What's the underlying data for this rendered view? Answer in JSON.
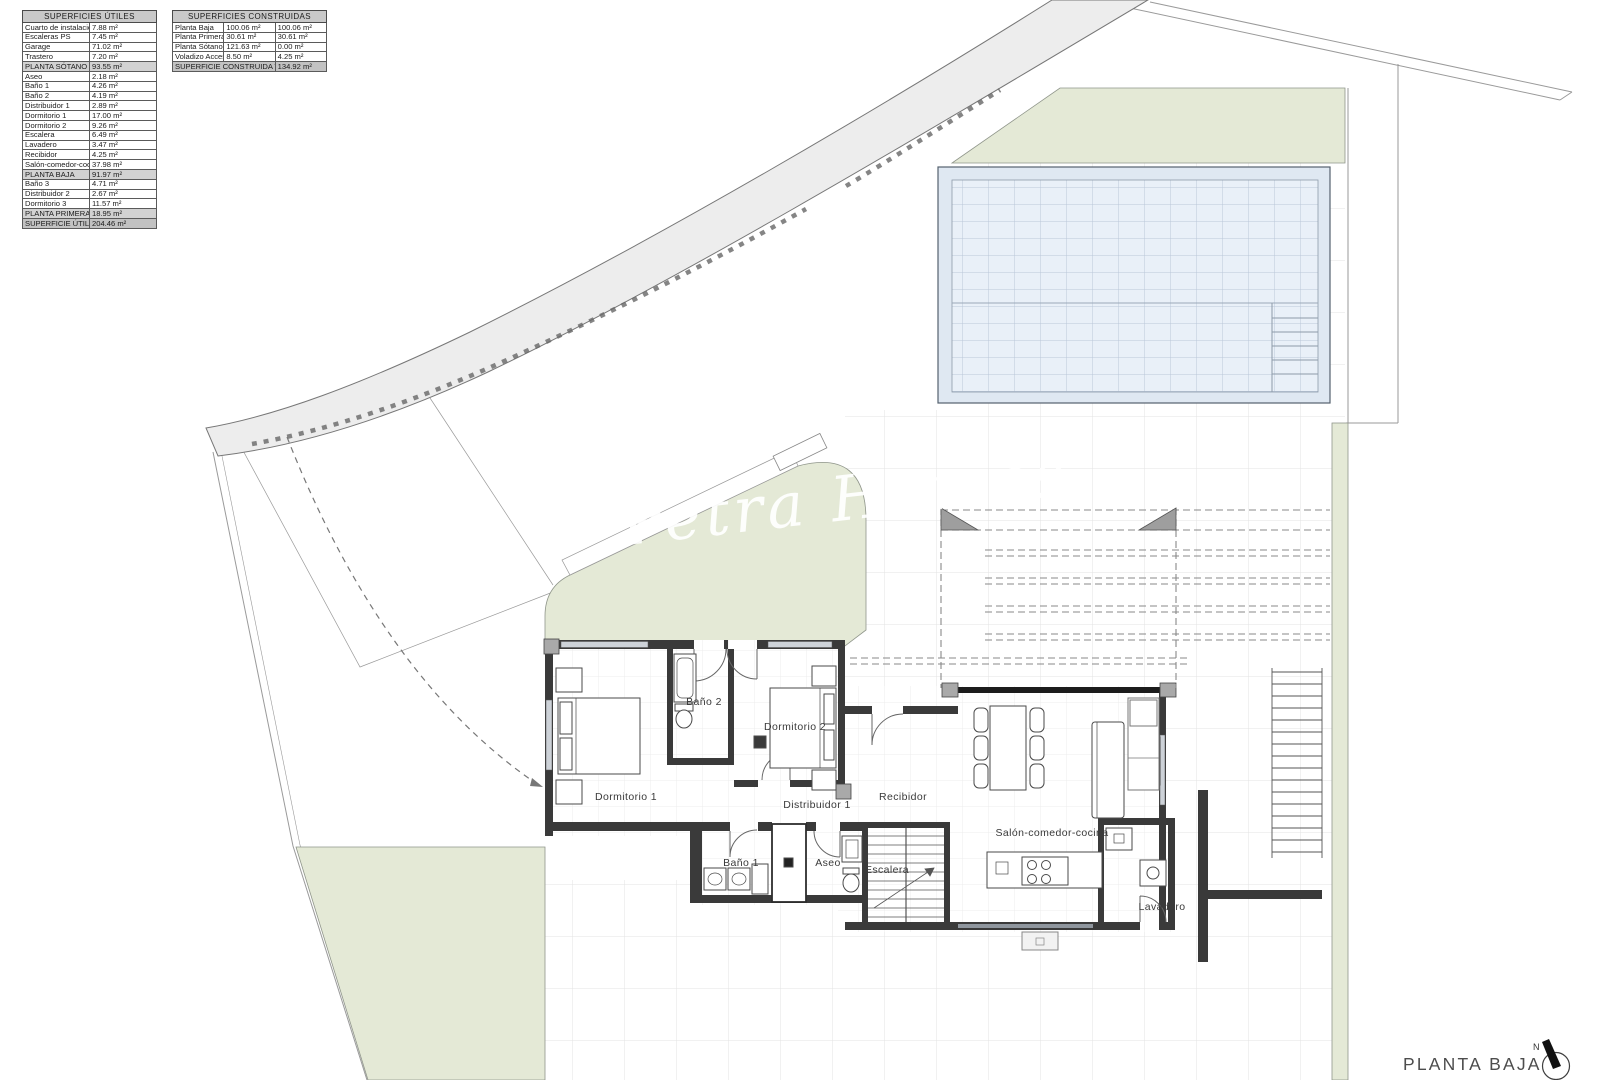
{
  "plan_title": "PLANTA BAJA",
  "watermark": "Petra Homes",
  "north_label": "N",
  "surface_tables": [
    {
      "id": "utiles",
      "title": "SUPERFICIES ÚTILES",
      "cols": 2,
      "rows": [
        {
          "label": "Cuarto de instalaciones",
          "values": [
            "7.88 m²"
          ]
        },
        {
          "label": "Escaleras PS",
          "values": [
            "7.45 m²"
          ]
        },
        {
          "label": "Garage",
          "values": [
            "71.02 m²"
          ]
        },
        {
          "label": "Trastero",
          "values": [
            "7.20 m²"
          ]
        },
        {
          "label": "PLANTA SÓTANO",
          "values": [
            "93.55 m²"
          ],
          "style": "subtotal"
        },
        {
          "label": "Aseo",
          "values": [
            "2.18 m²"
          ]
        },
        {
          "label": "Baño 1",
          "values": [
            "4.26 m²"
          ]
        },
        {
          "label": "Baño 2",
          "values": [
            "4.19 m²"
          ]
        },
        {
          "label": "Distribuidor 1",
          "values": [
            "2.89 m²"
          ]
        },
        {
          "label": "Dormitorio 1",
          "values": [
            "17.00 m²"
          ]
        },
        {
          "label": "Dormitorio 2",
          "values": [
            "9.26 m²"
          ]
        },
        {
          "label": "Escalera",
          "values": [
            "6.49 m²"
          ]
        },
        {
          "label": "Lavadero",
          "values": [
            "3.47 m²"
          ]
        },
        {
          "label": "Recibidor",
          "values": [
            "4.25 m²"
          ]
        },
        {
          "label": "Salón-comedor-cocina",
          "values": [
            "37.98 m²"
          ]
        },
        {
          "label": "PLANTA BAJA",
          "values": [
            "91.97 m²"
          ],
          "style": "subtotal"
        },
        {
          "label": "Baño 3",
          "values": [
            "4.71 m²"
          ]
        },
        {
          "label": "Distribuidor 2",
          "values": [
            "2.67 m²"
          ]
        },
        {
          "label": "Dormitorio 3",
          "values": [
            "11.57 m²"
          ]
        },
        {
          "label": "PLANTA PRIMERA",
          "values": [
            "18.95 m²"
          ],
          "style": "subtotal"
        },
        {
          "label": "SUPERFICIE ÚTIL TOTAL",
          "values": [
            "204.46 m²"
          ],
          "style": "total"
        }
      ]
    },
    {
      "id": "construidas",
      "title": "SUPERFICIES CONSTRUIDAS",
      "cols": 3,
      "rows": [
        {
          "label": "Planta Baja",
          "values": [
            "100.06 m²",
            "100.06 m²"
          ]
        },
        {
          "label": "Planta Primera",
          "values": [
            "30.61 m²",
            "30.61 m²"
          ]
        },
        {
          "label": "Planta Sótano(0%)",
          "values": [
            "121.63 m²",
            "0.00 m²"
          ]
        },
        {
          "label": "Voladizo Acceso(50%)",
          "values": [
            "8.50 m²",
            "4.25 m²"
          ]
        },
        {
          "label": "SUPERFICIE CONSTRUIDA TOTAL",
          "values": [
            "134.92 m²"
          ],
          "style": "total"
        }
      ]
    }
  ],
  "rooms": {
    "dormitorio1": "Dormitorio 1",
    "bano2": "Baño 2",
    "dormitorio2": "Dormitorio 2",
    "distribuidor1": "Distribuidor 1",
    "recibidor": "Recibidor",
    "bano1": "Baño 1",
    "aseo": "Aseo",
    "escalera": "Escalera",
    "salon": "Salón-comedor-cocina",
    "lavadero": "Lavadero"
  }
}
